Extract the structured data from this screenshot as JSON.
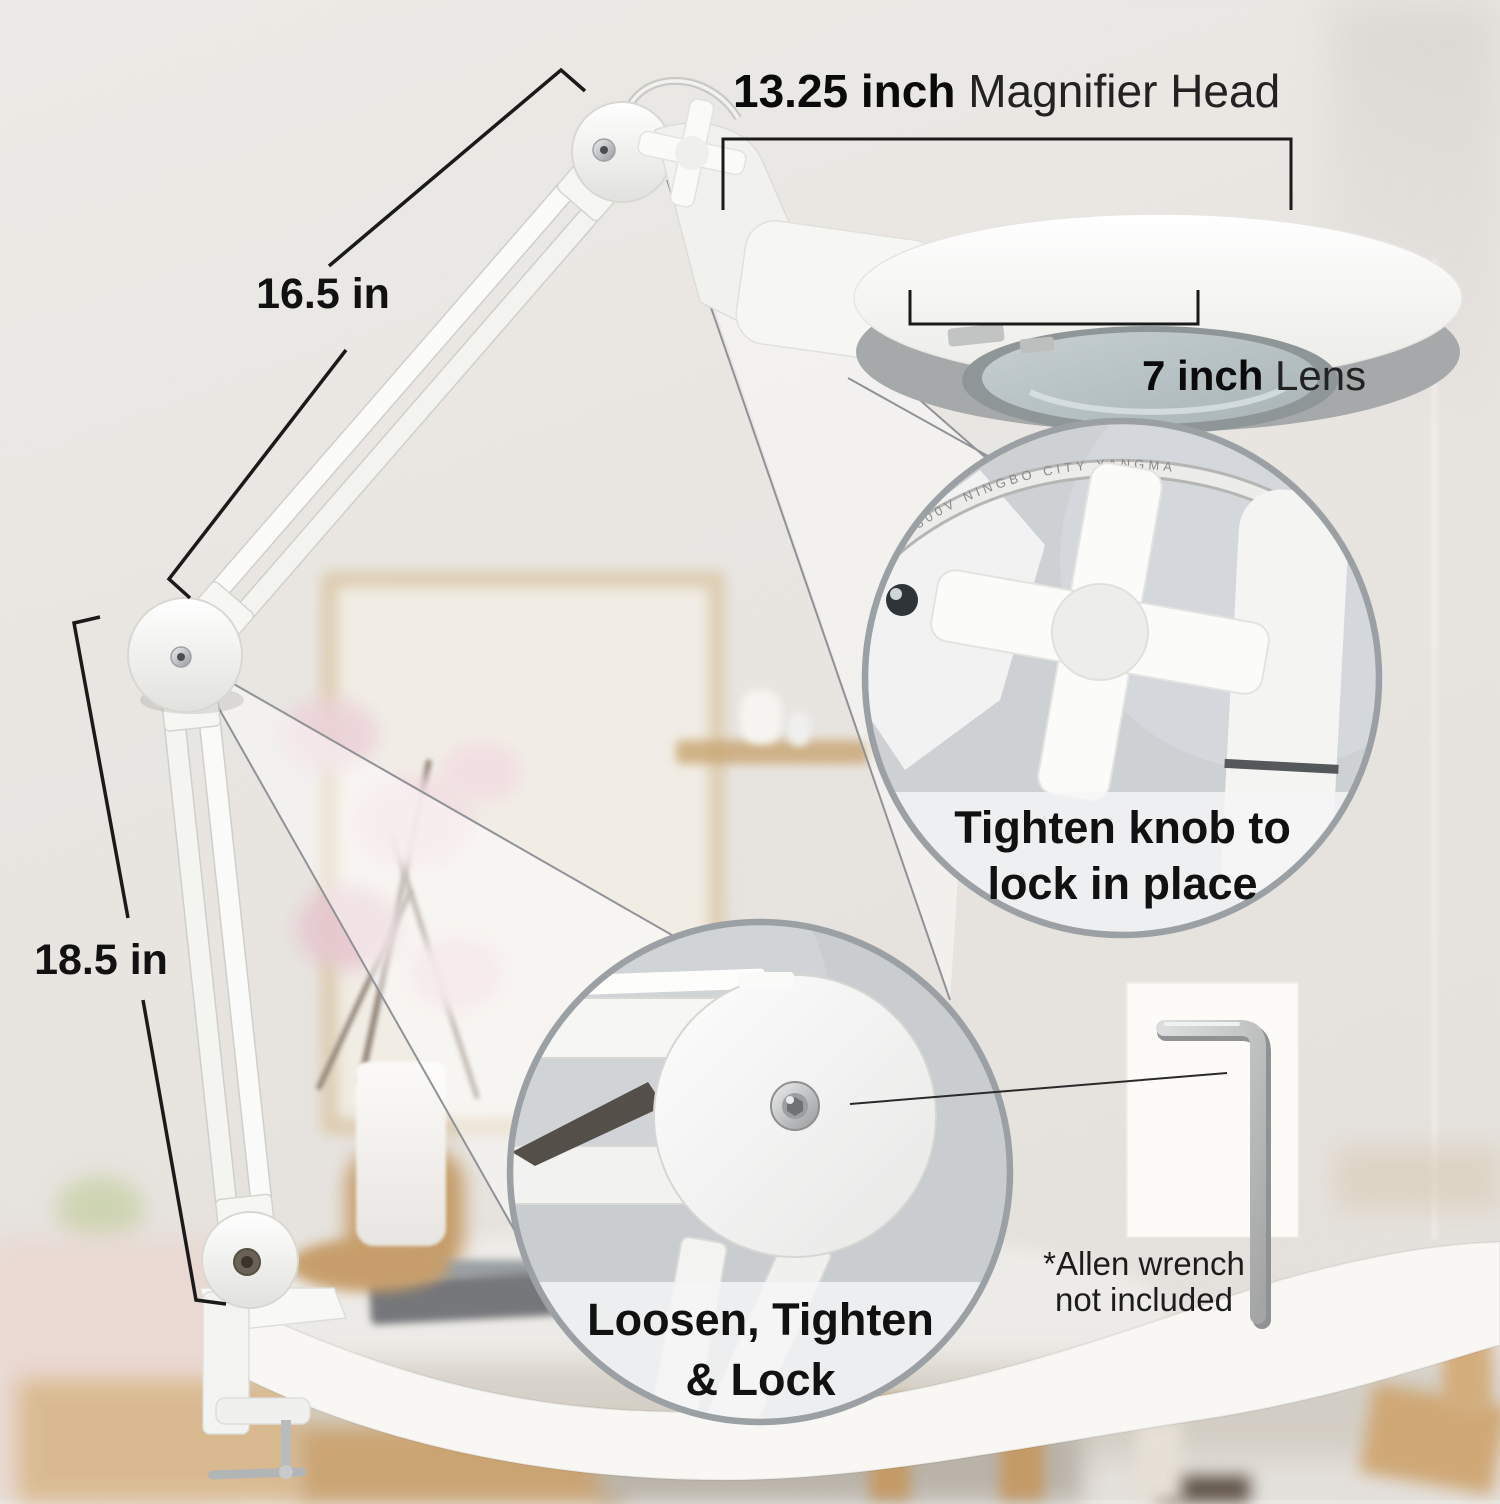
{
  "annotations": {
    "head": {
      "value": "13.25 inch",
      "label": "Magnifier Head"
    },
    "lens": {
      "value": "7 inch",
      "label": "Lens"
    },
    "upper_arm": {
      "value": "16.5 in"
    },
    "lower_arm": {
      "value": "18.5 in"
    }
  },
  "callouts": {
    "knob": {
      "line1": "Tighten knob to",
      "line2": "lock in place",
      "cable_print": "300V  NINGBO  CITY  YANGMA"
    },
    "elbow": {
      "line1": "Loosen, Tighten",
      "line2": "& Lock"
    },
    "allen": {
      "line1": "*Allen wrench",
      "line2": "not included"
    }
  },
  "colors": {
    "text": "#111111",
    "dim_line": "#1a1a1a",
    "callout_border": "#9aa0a3",
    "wedge_line": "#8f9296",
    "wall": "#e8e5e1",
    "table": "#f8f7f4",
    "wood": "#cfa877",
    "lens_glass": "#b9c4c6"
  }
}
